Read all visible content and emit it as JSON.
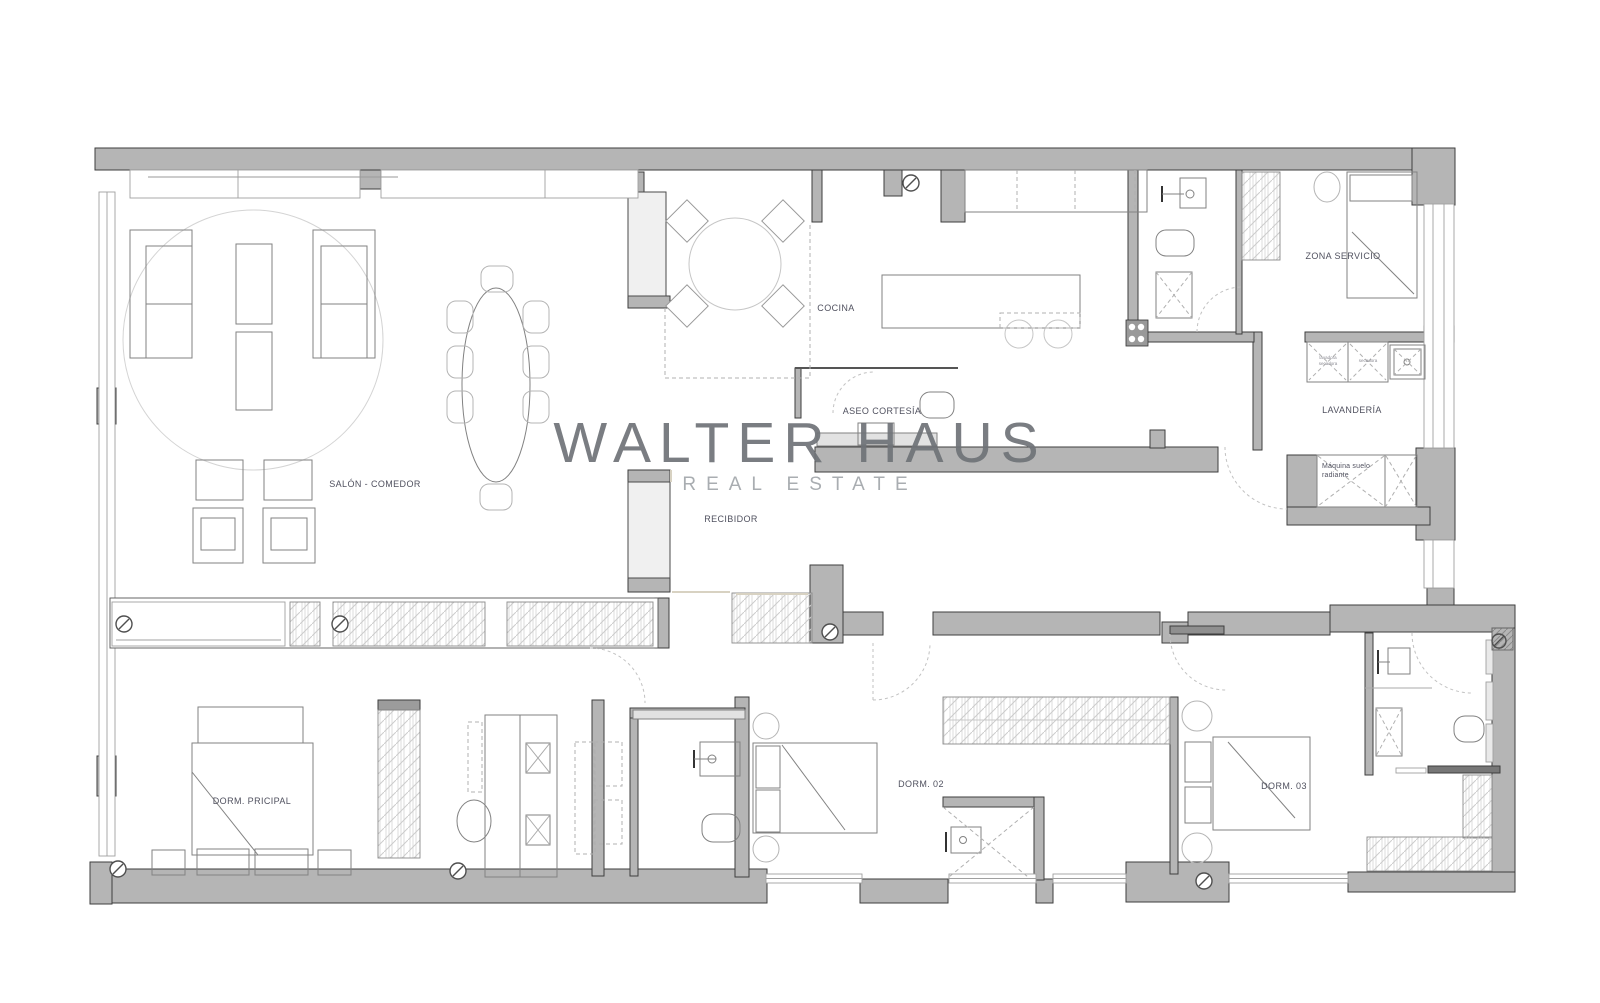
{
  "watermark": {
    "brand": "WALTER HAUS",
    "tagline": "REAL ESTATE"
  },
  "room_labels": {
    "salon_comedor": "SALÓN - COMEDOR",
    "cocina": "COCINA",
    "aseo_cortesia": "ASEO CORTESÍA",
    "recibidor": "RECIBIDOR",
    "zona_servicio": "ZONA SERVICIO",
    "lavanderia": "LAVANDERÍA",
    "maquina_line1": "Máquina suelo",
    "maquina_line2": "radiante",
    "dorm_principal": "DORM. PRICIPAL",
    "dorm_02": "DORM. 02",
    "dorm_03": "DORM. 03"
  },
  "equipment_labels": {
    "washer_line1": "lavadora",
    "washer_line2": "secadora",
    "dryer": "secadora"
  },
  "colors": {
    "wall_fill": "#b5b5b5",
    "wall_outline": "#3e3e3e",
    "label_text": "#50515f",
    "watermark_primary": "#6f7378",
    "watermark_secondary": "#a9adb1"
  }
}
